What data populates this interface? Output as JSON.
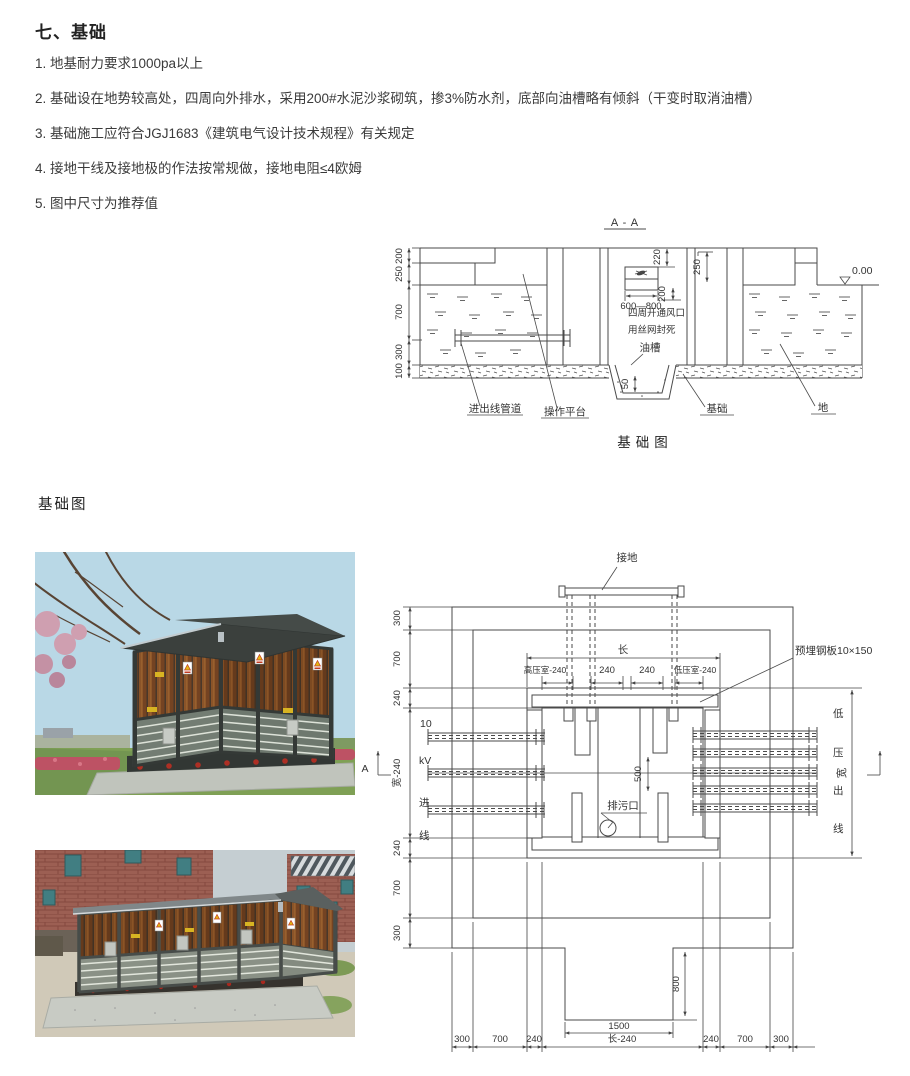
{
  "header": {
    "title": "七、基础",
    "items": [
      "1. 地基耐力要求1000pa以上",
      "2. 基础设在地势较高处，四周向外排水，采用200#水泥沙浆砌筑，掺3%防水剂，底部向油槽略有倾斜（干变时取消油槽）",
      "3. 基础施工应符合JGJ1683《建筑电气设计技术规程》有关规定",
      "4. 接地干线及接地极的作法按常规做，接地电阻≤4欧姆",
      "5. 图中尺寸为推荐值"
    ]
  },
  "aa": {
    "title": "A - A",
    "caption": "基础图",
    "dims": {
      "d200": "200",
      "d250": "250",
      "d700": "700",
      "d300": "300",
      "d100": "100",
      "vent_h": "220",
      "vent_w": "600—800",
      "vent_d": "200",
      "wall": "250",
      "groove": "50",
      "level": "0.00"
    },
    "notes": {
      "vent1": "四周开通风口",
      "vent2": "用丝网封死",
      "oil": "油槽"
    },
    "labels": {
      "conduit": "进出线管道",
      "platform": "操作平台",
      "foundation": "基础",
      "ground": "地"
    }
  },
  "photos": {
    "section_label": "基础图"
  },
  "plan": {
    "grounding": "接地",
    "steel_plate": "预埋钢板10×150",
    "drain": "排污口",
    "length": "长",
    "rooms": {
      "hv": "高压室-240",
      "m1": "240",
      "m2": "240",
      "lv": "低压室-240"
    },
    "left_dims": [
      "300",
      "700",
      "240",
      "宽-240",
      "240",
      "700",
      "300"
    ],
    "bottom_dims": [
      "300",
      "700",
      "240",
      "长-240",
      "240",
      "700",
      "300"
    ],
    "d500": "500",
    "d800": "800",
    "d1500": "1500",
    "left_text": [
      "10",
      "kV",
      "进",
      "线"
    ],
    "right_text": [
      "低",
      "压",
      "出",
      "线"
    ],
    "width": "宽",
    "marker": "A"
  }
}
